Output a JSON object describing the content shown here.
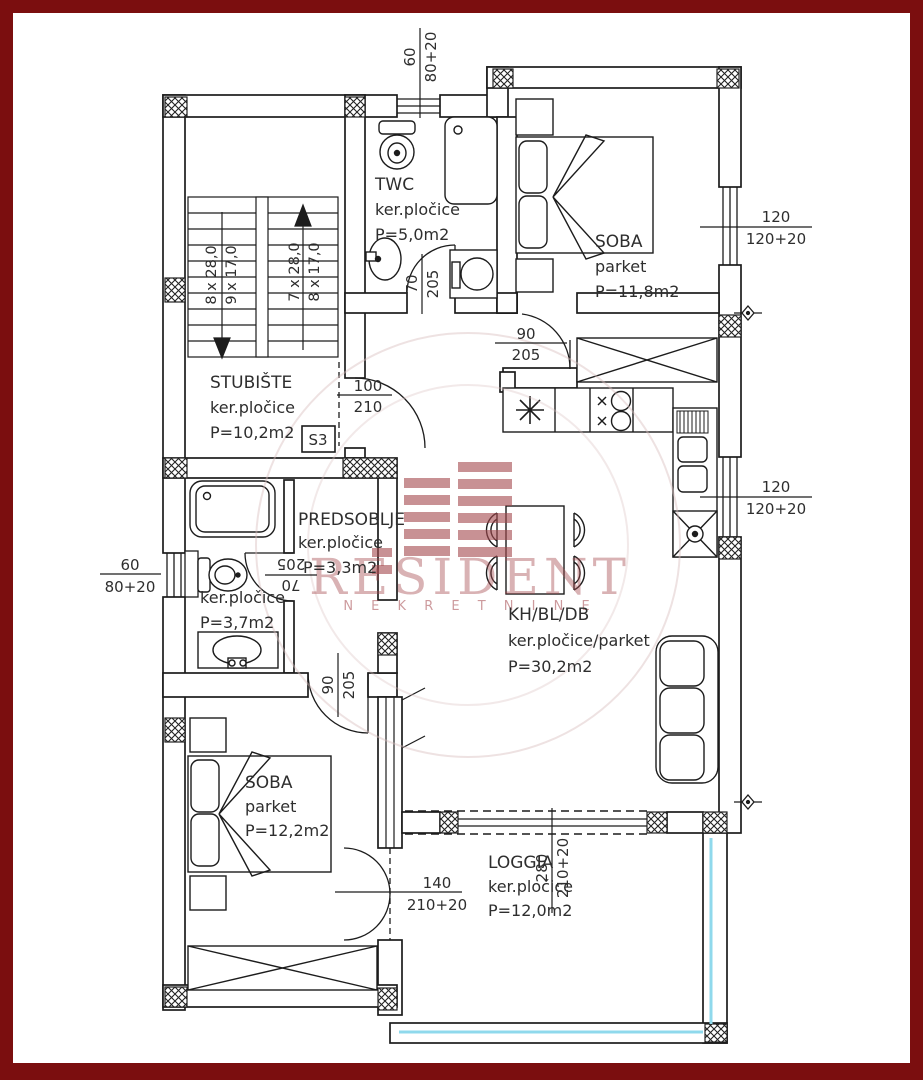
{
  "watermark": {
    "brand": "RESIDENT",
    "subtitle": "N E K R E T N I N E"
  },
  "unit_badge": "S3",
  "rooms": {
    "twc": {
      "name": "TWC",
      "floor": "ker.pločice",
      "area": "P=5,0m2"
    },
    "soba1": {
      "name": "SOBA",
      "floor": "parket",
      "area": "P=11,8m2"
    },
    "stubiste": {
      "name": "STUBIŠTE",
      "floor": "ker.pločice",
      "area": "P=10,2m2"
    },
    "predsoblje": {
      "name": "PREDSOBLJE",
      "floor": "ker.pločice",
      "area": "P=3,3m2"
    },
    "kupaonica": {
      "floor": "ker.pločice",
      "area": "P=3,7m2"
    },
    "dnevni": {
      "name": "KH/BL/DB",
      "floor": "ker.pločice/parket",
      "area": "P=30,2m2"
    },
    "soba2": {
      "name": "SOBA",
      "floor": "parket",
      "area": "P=12,2m2"
    },
    "loggia": {
      "name": "LOGGIA",
      "floor": "ker.pločice",
      "area": "P=12,0m2"
    }
  },
  "stairs": {
    "down_flight": {
      "treads": "8 x 28,0",
      "risers": "9 x 17,0"
    },
    "up_flight": {
      "treads": "7 x 28,0",
      "risers": "8 x 17,0"
    }
  },
  "dims": {
    "top_window": {
      "a": "60",
      "b": "80+20"
    },
    "right_window_upper": {
      "a": "120",
      "b": "120+20"
    },
    "right_window_lower": {
      "a": "120",
      "b": "120+20"
    },
    "twc_door": {
      "a": "70",
      "b": "205"
    },
    "soba1_door": {
      "a": "90",
      "b": "205"
    },
    "entry_door": {
      "a": "100",
      "b": "210"
    },
    "left_window": {
      "a": "60",
      "b": "80+20"
    },
    "bath_door": {
      "a": "70",
      "b": "205"
    },
    "soba2_door": {
      "a": "90",
      "b": "205"
    },
    "loggia_door": {
      "a": "140",
      "b": "210+20"
    },
    "loggia_slider": {
      "a": "280",
      "b": "210+20"
    }
  },
  "colors": {
    "frame": "#7b0e0f",
    "railing": "#8fd9ec",
    "watermark": "#a5494e",
    "line": "#1c1c1c"
  }
}
